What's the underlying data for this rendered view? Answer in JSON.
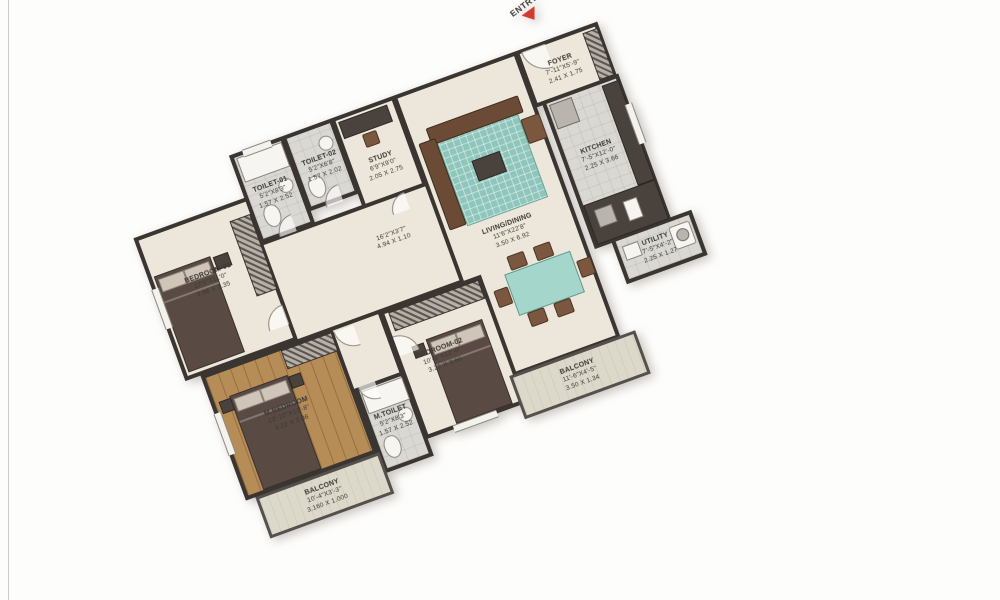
{
  "plan": {
    "entry": {
      "label": "ENTRY"
    },
    "colors": {
      "wall": "#3a3531",
      "floor_cream": "#ece7da",
      "floor_tile": "#d9d8d2",
      "floor_wood": "#b68c57",
      "accent_teal": "#a4d6cc",
      "bed_brown": "#594a44",
      "entry_arrow_red": "#d43a2c"
    },
    "rooms": {
      "bedroom1": {
        "name": "BEDROOM-01",
        "dims_ft": "12'0\"X11'0\"",
        "dims_m": "3.66 X 3.35"
      },
      "toilet1": {
        "name": "TOILET-01",
        "dims_ft": "5'2\"X8'3\"",
        "dims_m": "1.57 X 2.52"
      },
      "toilet2": {
        "name": "TOILET-02",
        "dims_ft": "5'2\"X6'8\"",
        "dims_m": "1.57 X 2.02"
      },
      "study": {
        "name": "STUDY",
        "dims_ft": "6'9\"X9'0\"",
        "dims_m": "2.05 X 2.75"
      },
      "foyer": {
        "name": "FOYER",
        "dims_ft": "7'-11\"X5'-9\"",
        "dims_m": "2.41 X 1.75"
      },
      "kitchen": {
        "name": "KITCHEN",
        "dims_ft": "7'-5\"X12'-0\"",
        "dims_m": "2.25 X 3.66"
      },
      "utility": {
        "name": "UTILITY",
        "dims_ft": "7'-5\"X4'-2\"",
        "dims_m": "2.25 X 1.27"
      },
      "living": {
        "name": "LIVING/DINING",
        "dims_ft": "11'6\"X22'8\"",
        "dims_m": "3.50 X 6.92"
      },
      "balcony_right": {
        "name": "BALCONY",
        "dims_ft": "11'-6\"X4'-5\"",
        "dims_m": "3.50 X 1.34"
      },
      "bedroom2": {
        "name": "BEDROOM-02",
        "dims_ft": "10'-6\"X12'-0\"",
        "dims_m": "3.21 X 3.66"
      },
      "mbedroom": {
        "name": "M.BEDROOM",
        "dims_ft": "13'-10\"X12'-8\"",
        "dims_m": "4.22 X 3.86"
      },
      "mtoilet": {
        "name": "M.TOILET",
        "dims_ft": "5'2\"X8'3\"",
        "dims_m": "1.57 X 2.52"
      },
      "balcony_bottom": {
        "name": "BALCONY",
        "dims_ft": "10'-4\"X3'-3\"",
        "dims_m": "3.160 X 1.000"
      },
      "passage": {
        "dims_ft": "16'2\"X3'7\"",
        "dims_m": "4.94 X 1.10"
      }
    }
  }
}
